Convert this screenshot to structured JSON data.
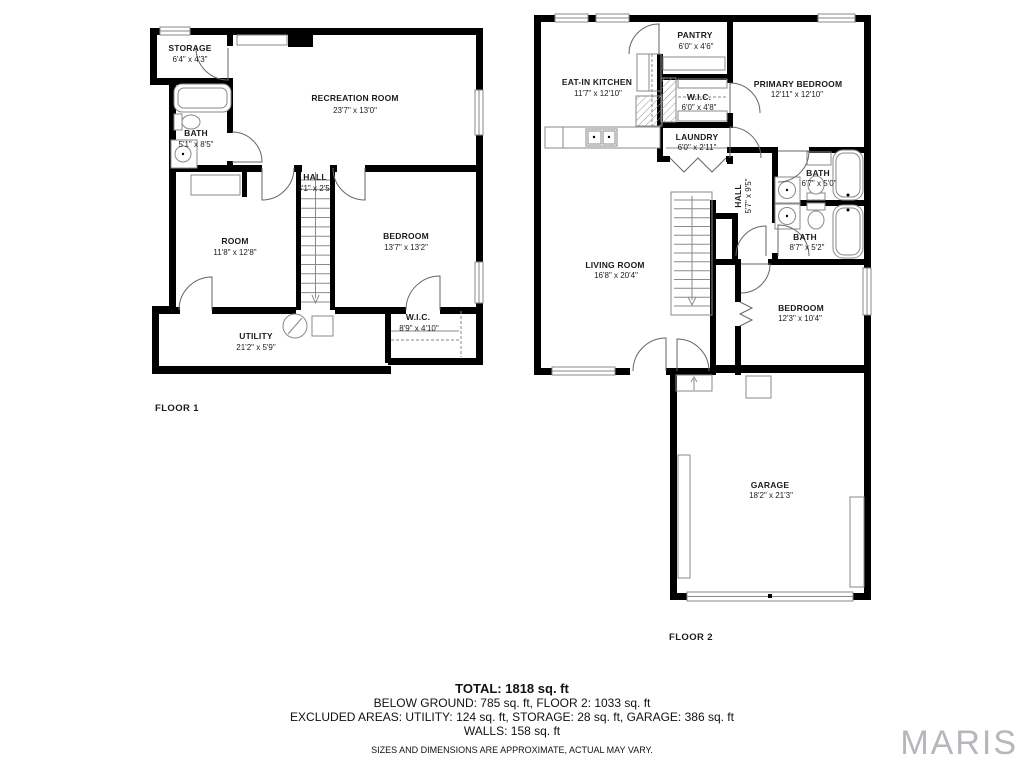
{
  "floor1": {
    "label": "FLOOR 1",
    "rooms": [
      {
        "name": "STORAGE",
        "dims": "6'4\" x 4'3\""
      },
      {
        "name": "BATH",
        "dims": "5'1\" x 8'5\""
      },
      {
        "name": "RECREATION ROOM",
        "dims": "23'7\" x 13'0\""
      },
      {
        "name": "HALL",
        "dims": "3'1\" x 2'5\""
      },
      {
        "name": "ROOM",
        "dims": "11'8\" x 12'8\""
      },
      {
        "name": "BEDROOM",
        "dims": "13'7\" x 13'2\""
      },
      {
        "name": "UTILITY",
        "dims": "21'2\" x 5'9\""
      },
      {
        "name": "W.I.C.",
        "dims": "8'9\" x 4'10\""
      }
    ]
  },
  "floor2": {
    "label": "FLOOR 2",
    "rooms": [
      {
        "name": "EAT-IN KITCHEN",
        "dims": "11'7\" x 12'10\""
      },
      {
        "name": "PANTRY",
        "dims": "6'0\" x 4'6\""
      },
      {
        "name": "W.I.C.",
        "dims": "6'0\" x 4'8\""
      },
      {
        "name": "LAUNDRY",
        "dims": "6'0\" x 2'11\""
      },
      {
        "name": "PRIMARY BEDROOM",
        "dims": "12'11\" x 12'10\""
      },
      {
        "name": "BATH",
        "dims": "6'7\" x 5'0\""
      },
      {
        "name": "BATH",
        "dims": "8'7\" x 5'2\""
      },
      {
        "name": "HALL",
        "dims": "5'7\" x 9'5\""
      },
      {
        "name": "LIVING ROOM",
        "dims": "16'8\" x 20'4\""
      },
      {
        "name": "BEDROOM",
        "dims": "12'3\" x 10'4\""
      },
      {
        "name": "GARAGE",
        "dims": "18'2\" x 21'3\""
      }
    ]
  },
  "summary": {
    "total": "TOTAL: 1818 sq. ft",
    "below_ground_line": "BELOW GROUND: 785 sq. ft, FLOOR 2: 1033 sq. ft",
    "excluded_line": "EXCLUDED AREAS: UTILITY: 124 sq. ft, STORAGE: 28 sq. ft, GARAGE: 386 sq. ft",
    "walls_line": "WALLS: 158 sq. ft",
    "disclaimer": "SIZES AND DIMENSIONS ARE APPROXIMATE, ACTUAL MAY VARY."
  },
  "branding": {
    "logo": "MARIS"
  },
  "colors": {
    "wall": "#000000",
    "line": "#8a8a8a",
    "text": "#1c1c1c",
    "logo": "#b4b7bb"
  }
}
